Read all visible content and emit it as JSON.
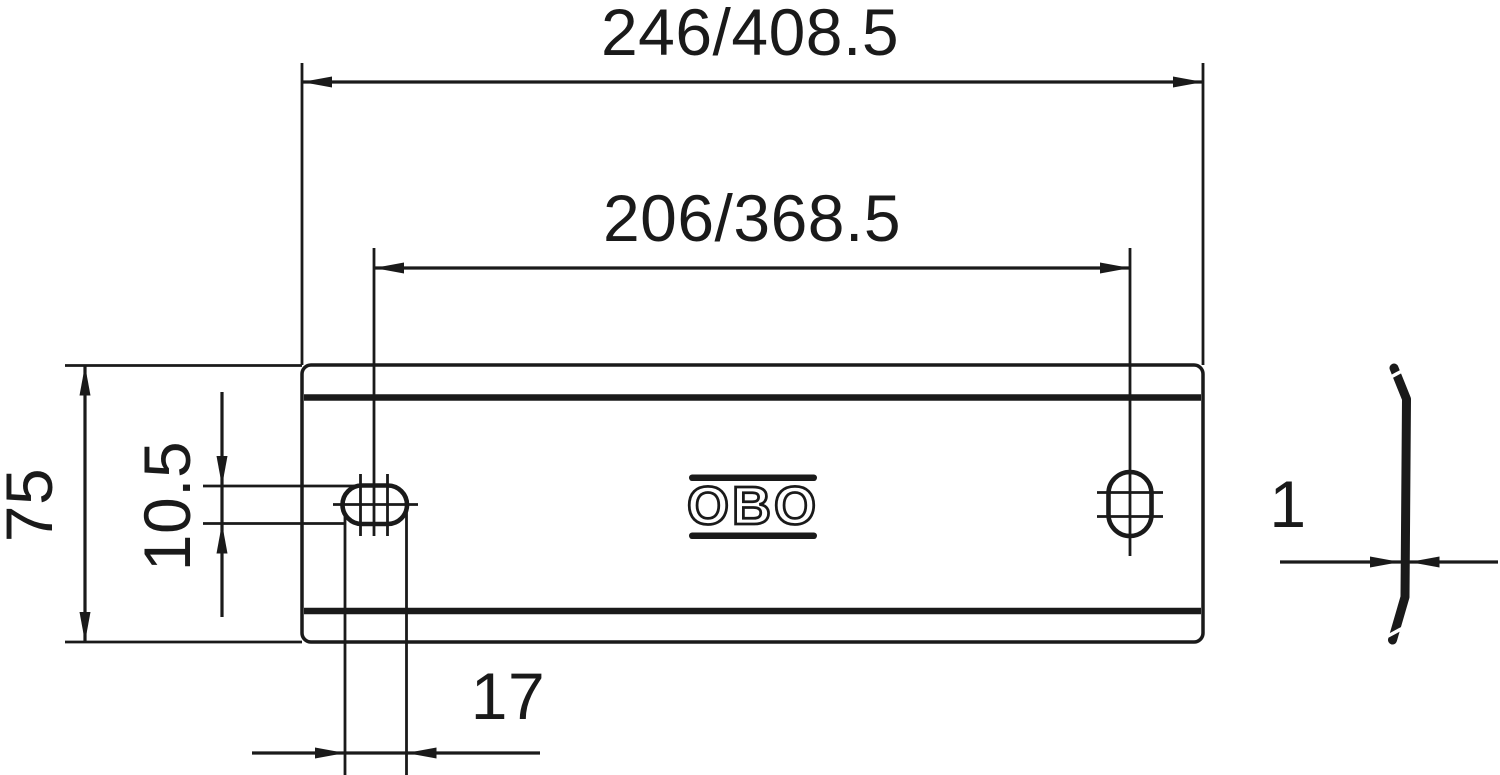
{
  "meta": {
    "type": "technical-dimension-drawing",
    "line_color": "#1a1a1a",
    "background_color": "#ffffff"
  },
  "front_view": {
    "logo_text": "OBO"
  },
  "dimensions": {
    "overall_width": {
      "label": "246/408.5"
    },
    "hole_spacing": {
      "label": "206/368.5"
    },
    "overall_height": {
      "label": "75"
    },
    "slot_height": {
      "label": "10.5"
    },
    "slot_width": {
      "label": "17"
    },
    "thickness": {
      "label": "1"
    }
  }
}
